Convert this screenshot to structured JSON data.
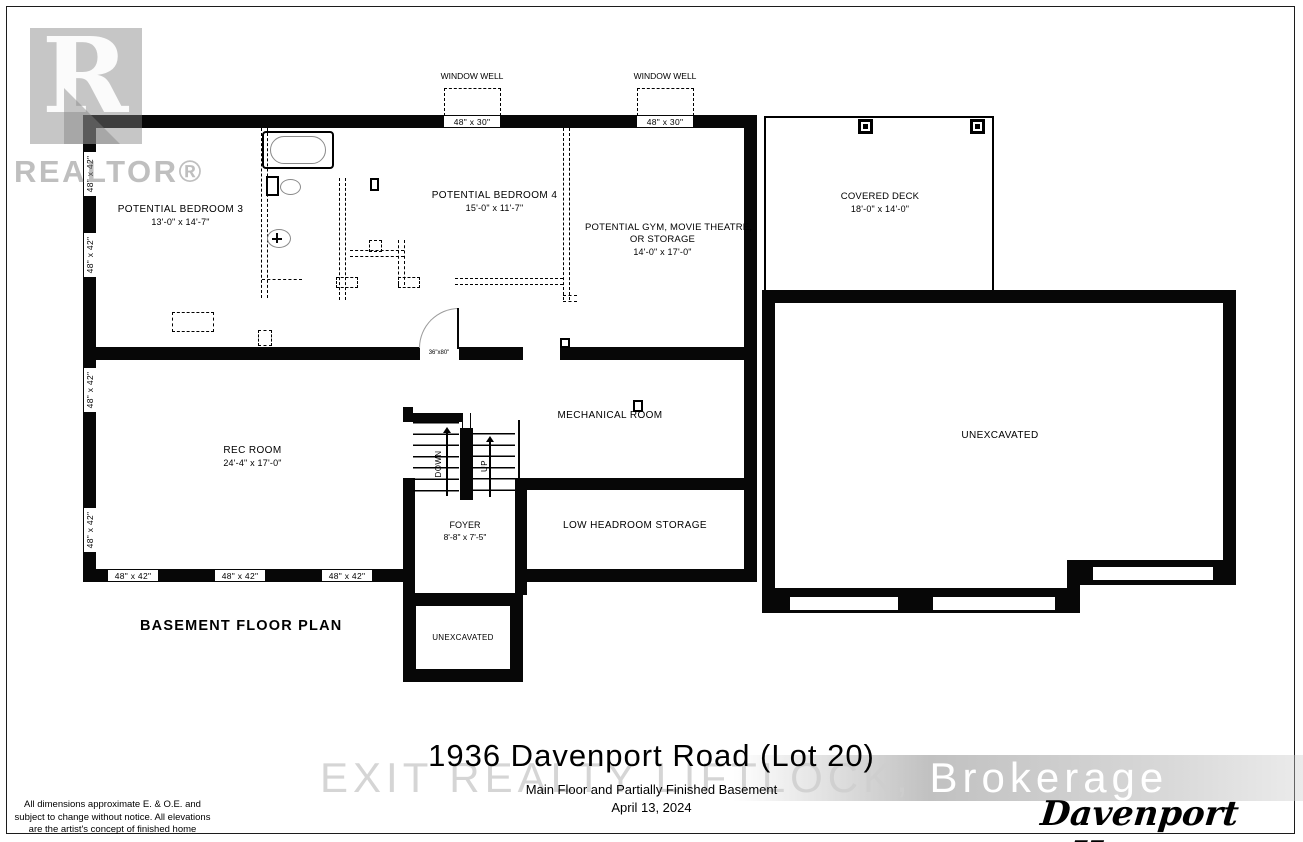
{
  "page": {
    "title": "1936 Davenport Road (Lot 20)",
    "subtitle": "Main Floor and Partially Finished Basement",
    "date": "April 13, 2024",
    "plan_label": "BASEMENT FLOOR PLAN",
    "builder_logo": "Davenport Homes",
    "disclaimer": [
      "All dimensions approximate E. & O.E. and",
      "subject to change without notice.  All elevations",
      "are the artist's concept of finished home"
    ]
  },
  "watermarks": {
    "realtor_letter": "R",
    "realtor_text": "REALTOR®",
    "brokerage_left": "EXIT REALTY LIFTLOCK, ",
    "brokerage_right": "Brokerage"
  },
  "rooms": {
    "bedroom3": {
      "name": "POTENTIAL BEDROOM 3",
      "dims": "13'-0\" x 14'-7\""
    },
    "bedroom4": {
      "name": "POTENTIAL BEDROOM 4",
      "dims": "15'-0\" x 11'-7\""
    },
    "gym": {
      "line1": "POTENTIAL GYM, MOVIE THEATRE,",
      "line2": "OR STORAGE",
      "dims": "14'-0\" x 17'-0\""
    },
    "deck": {
      "name": "COVERED DECK",
      "dims": "18'-0\" x 14'-0\""
    },
    "rec": {
      "name": "REC ROOM",
      "dims": "24'-4\" x 17'-0\""
    },
    "mechanical": {
      "name": "MECHANICAL ROOM"
    },
    "storage": {
      "name": "LOW HEADROOM STORAGE"
    },
    "foyer": {
      "name": "FOYER",
      "dims": "8'-8\" x 7'-5\""
    },
    "unexcavated_right": {
      "name": "UNEXCAVATED"
    },
    "unexcavated_bottom": {
      "name": "UNEXCAVATED"
    }
  },
  "stairs": {
    "down": "DOWN",
    "up": "UP",
    "door_size": "36\"x80\""
  },
  "windows": {
    "well_label": "WINDOW WELL",
    "top_size": "48\" x 30\"",
    "side_size": "48\" x 42\""
  },
  "colors": {
    "wall": "#070707",
    "watermark_gray": "#b9b9b9"
  }
}
